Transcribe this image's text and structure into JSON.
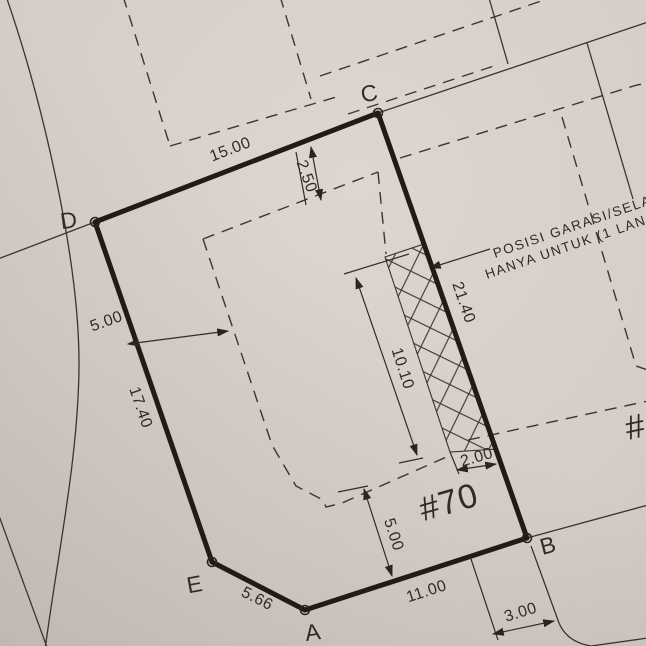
{
  "meta": {
    "title": "Scanned lot site plan",
    "paper_color": "#d5cec6",
    "ink_color": "#201b16",
    "lot_number": "#70",
    "neighbor_lot_partial": "#"
  },
  "vertices": {
    "a": "A",
    "b": "B",
    "c": "C",
    "d": "D",
    "e": "E"
  },
  "dims": {
    "edge_dc": "15.00",
    "edge_cb": "21.40",
    "edge_ed": "17.40",
    "edge_ab": "11.00",
    "edge_ea": "5.66",
    "setback_front": "2.50",
    "setback_left": "5.00",
    "setback_bottom": "5.00",
    "garage_length": "10.10",
    "garage_width": "2.00",
    "frontage_right": "3.00"
  },
  "note": {
    "line1": "POSISI GARASI/SELASAR",
    "line2": "HANYA UNTUK (1 LAN"
  }
}
